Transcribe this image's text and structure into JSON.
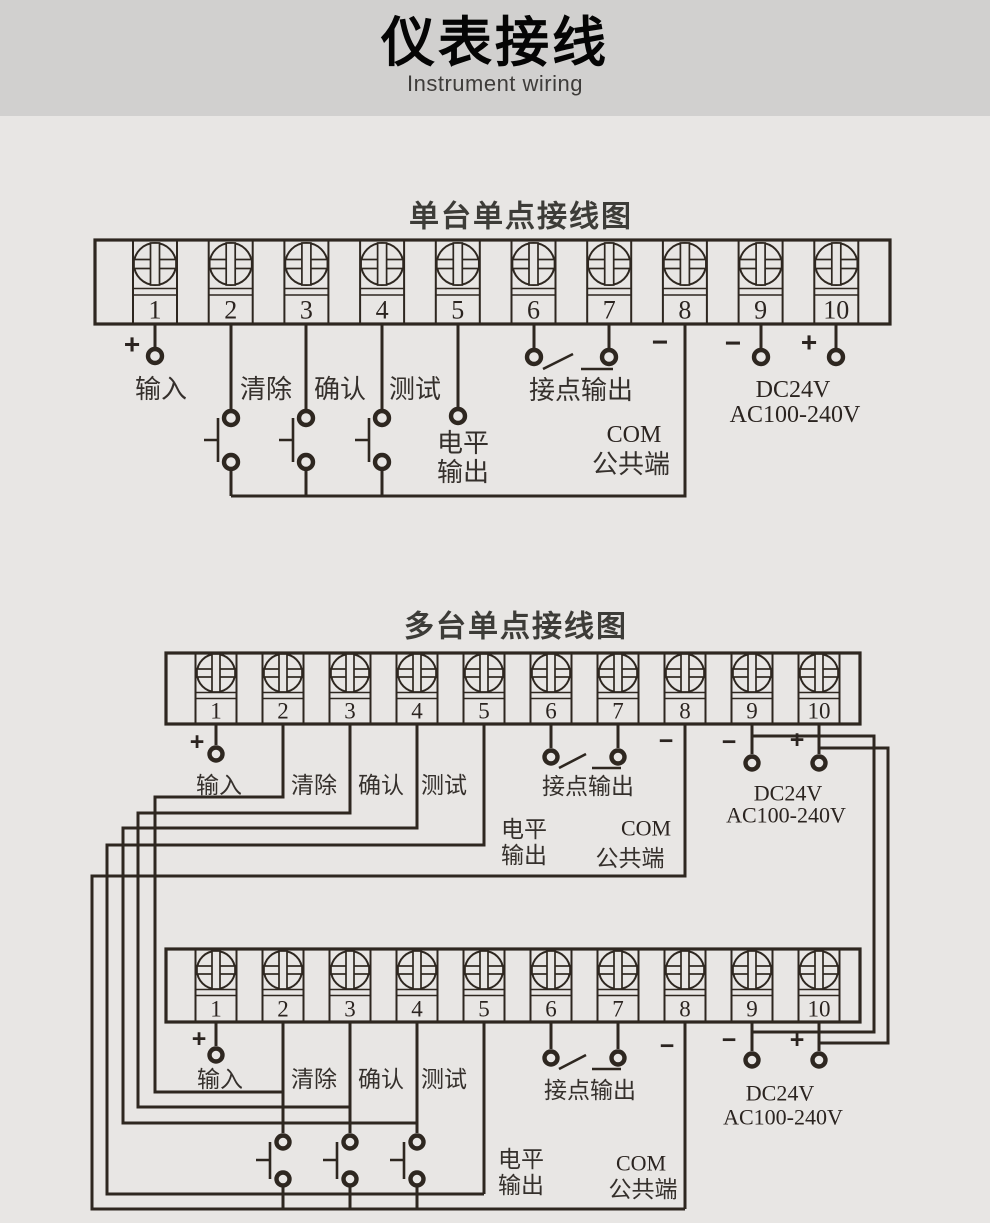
{
  "header": {
    "title": "仪表接线",
    "subtitle": "Instrument wiring"
  },
  "terminal_numbers": [
    "1",
    "2",
    "3",
    "4",
    "5",
    "6",
    "7",
    "8",
    "9",
    "10"
  ],
  "labels": {
    "plus": "+",
    "minus": "−",
    "input": "输入",
    "clear": "清除",
    "confirm": "确认",
    "test": "测试",
    "level_line1": "电平",
    "level_line2": "输出",
    "contact_output": "接点输出",
    "com": "COM",
    "com_common": "公共端",
    "power_dc": "DC24V",
    "power_ac": "AC100-240V"
  },
  "diagram_single": {
    "title": "单台单点接线图"
  },
  "diagram_multi": {
    "title": "多台单点接线图"
  },
  "colors": {
    "background": "#e8e6e4",
    "header_band": "#d1d0cf",
    "line": "#2e2720",
    "chinese_text": "#35302c",
    "latin_text": "#2b2420"
  }
}
